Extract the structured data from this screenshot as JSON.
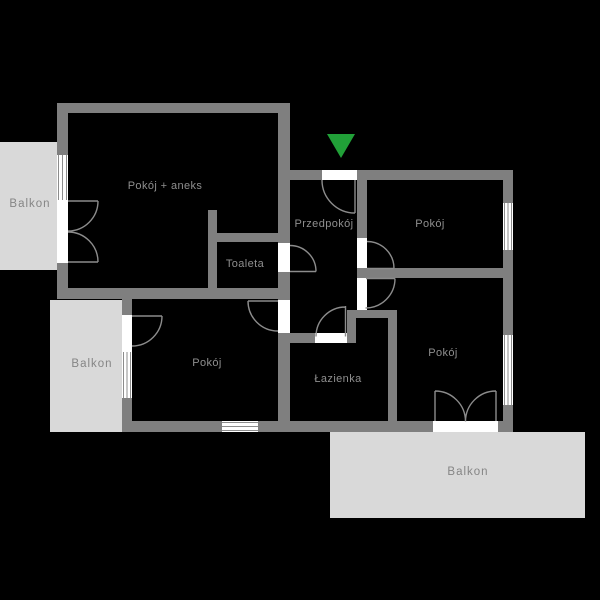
{
  "floorplan": {
    "rooms": [
      {
        "id": "pokoj-aneks",
        "label": "Pokój + aneks"
      },
      {
        "id": "przedpokoj",
        "label": "Przedpokój"
      },
      {
        "id": "pokoj-top-right",
        "label": "Pokój"
      },
      {
        "id": "toaleta",
        "label": "Toaleta"
      },
      {
        "id": "pokoj-bottom-left",
        "label": "Pokój"
      },
      {
        "id": "lazienka",
        "label": "Łazienka"
      },
      {
        "id": "pokoj-bottom-right",
        "label": "Pokój"
      }
    ],
    "balconies": [
      {
        "id": "balkon-top-left",
        "label": "Balkon"
      },
      {
        "id": "balkon-bottom-left",
        "label": "Balkon"
      },
      {
        "id": "balkon-bottom",
        "label": "Balkon"
      }
    ],
    "icons": {
      "entrance_marker": "entrance-arrow-down-icon"
    },
    "colors": {
      "background": "#000000",
      "wall": "#7f7f7f",
      "balcony": "#d9d9d9",
      "room_label": "#8f8f8f",
      "balcony_label": "#858585",
      "door_line": "#8c8c8c",
      "window_glass": "#ffffff",
      "entrance_green": "#21a038"
    }
  }
}
